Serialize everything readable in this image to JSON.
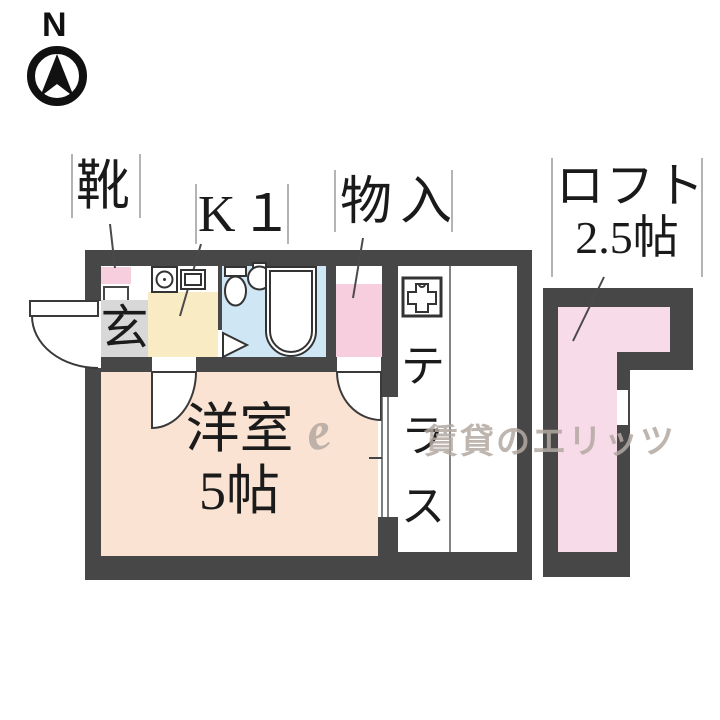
{
  "compass": {
    "north": "N"
  },
  "labels": {
    "shoes": "靴",
    "kitchen": "K１",
    "closet": "物入",
    "loft": "ロフト",
    "loft_size": "2.5帖",
    "entrance": "玄",
    "room": "洋室",
    "room_size": "5帖",
    "terrace": [
      "テ",
      "ラ",
      "ス"
    ]
  },
  "watermark": {
    "script": "e",
    "text": "賃貸のエリッツ"
  },
  "icons": [
    "north-compass-icon",
    "stove-icon",
    "sink-icon",
    "toilet-icon",
    "washbasin-icon",
    "bathtub-icon",
    "folding-door-icon",
    "washer-pan-icon",
    "door-swing-icon",
    "window-icon"
  ],
  "colors": {
    "wall": "#474747",
    "room_floor": "#fae3d2",
    "kitchen_floor": "#f9ecc4",
    "bath_floor": "#cfe6f4",
    "closet_pink": "#f7cede",
    "loft_pink": "#f8dbe8",
    "genkan_gray": "#d8d8d8",
    "watermark_gray": "#b3a9a2"
  }
}
